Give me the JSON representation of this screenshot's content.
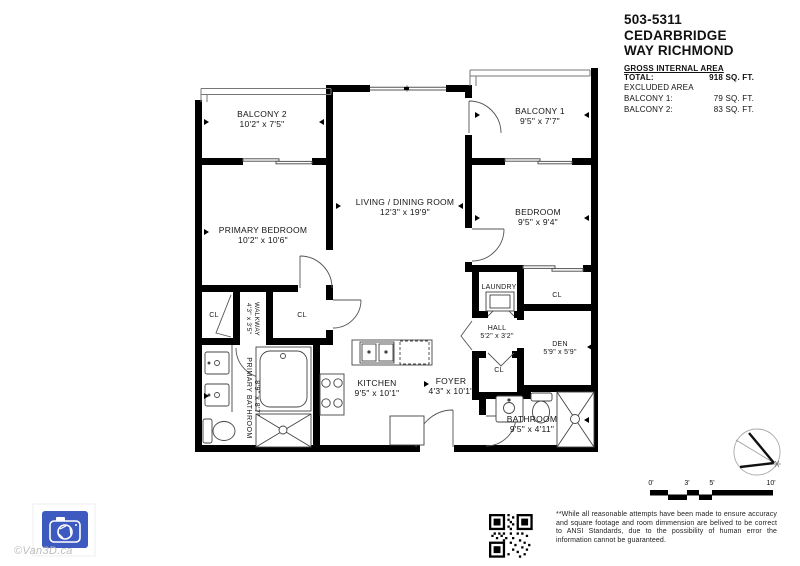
{
  "header": {
    "title_line1": "503-5311 CEDARBRIDGE",
    "title_line2": "WAY RICHMOND",
    "gross_area_label": "GROSS INTERNAL AREA",
    "total_label": "TOTAL:",
    "total_value": "918 SQ. FT.",
    "excluded_label": "EXCLUDED AREA",
    "excluded_items": [
      {
        "label": "BALCONY 1:",
        "value": "79 SQ. FT."
      },
      {
        "label": "BALCONY 2:",
        "value": "83 SQ. FT."
      }
    ]
  },
  "rooms": {
    "balcony2": {
      "name": "BALCONY 2",
      "dims": "10'2\" x 7'5\""
    },
    "primary_bedroom": {
      "name": "PRIMARY BEDROOM",
      "dims": "10'2\" x 10'6\""
    },
    "living_dining": {
      "name": "LIVING / DINING ROOM",
      "dims": "12'3\" x 19'9\""
    },
    "balcony1": {
      "name": "BALCONY 1",
      "dims": "9'5\" x 7'7\""
    },
    "bedroom": {
      "name": "BEDROOM",
      "dims": "9'5\" x 9'4\""
    },
    "laundry": {
      "name": "LAUNDRY"
    },
    "hall": {
      "name": "HALL",
      "dims": "5'2\" x 3'2\""
    },
    "den": {
      "name": "DEN",
      "dims": "5'9\" x 5'9\""
    },
    "kitchen": {
      "name": "KITCHEN",
      "dims": "9'5\" x 10'1\""
    },
    "foyer": {
      "name": "FOYER",
      "dims": "4'3\" x 10'1\""
    },
    "bathroom": {
      "name": "BATHROOM",
      "dims": "9'5\" x 4'11\""
    },
    "primary_bathroom": {
      "name": "PRIMARY BATHROOM",
      "dims": "8'9\" x 8'7\""
    },
    "walkway": {
      "name": "WALKWAY",
      "dims": "4'3\" x 3'5\""
    }
  },
  "closets": [
    "CL",
    "CL",
    "CL",
    "CL"
  ],
  "scale_bar": {
    "ticks": [
      "0'",
      "3'",
      "5'",
      "10'"
    ]
  },
  "footer": {
    "disclaimer": "**While all reasonable attempts have been made to ensure accuracy and square footage and room dimmension are belived to be correct to ANSI Standards, due to the possibility of human error the information cannot be guaranteed.",
    "watermark": "©Van3D.ca"
  },
  "colors": {
    "wall": "#000000",
    "logo_blue": "#3d5ac0",
    "watermark_gray": "#bdbdbd"
  }
}
